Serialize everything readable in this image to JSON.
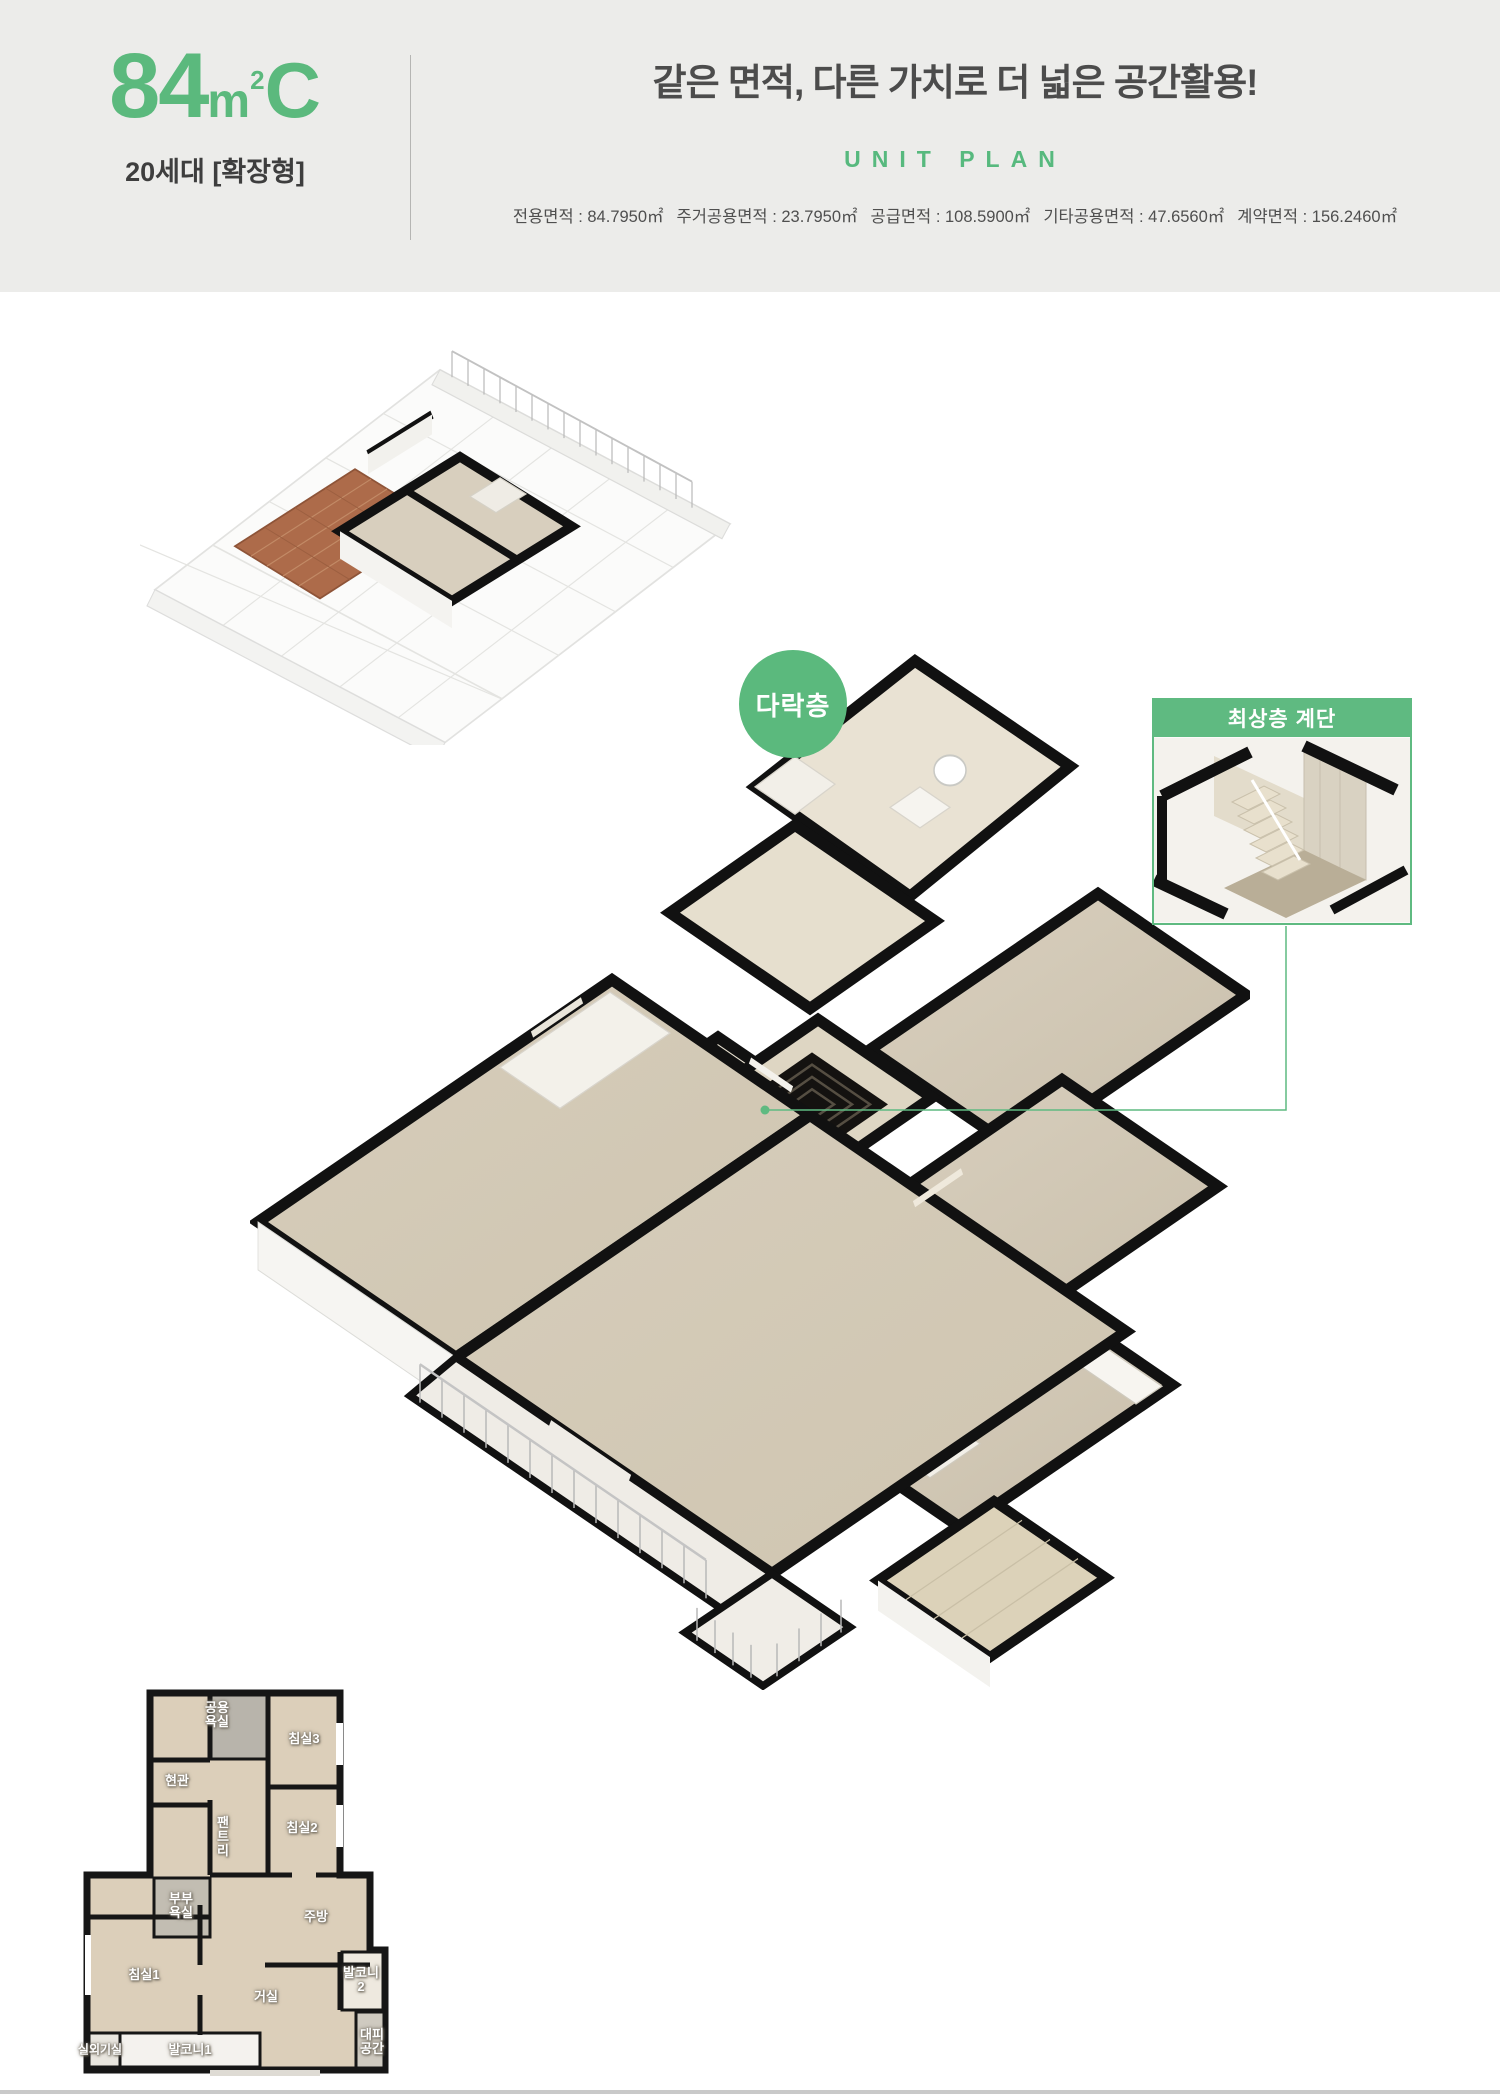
{
  "accent_color": "#5bb97d",
  "header": {
    "unit_number": "84",
    "unit_m": "m",
    "unit_sup": "2",
    "unit_type_letter": "C",
    "subtitle": "20세대 [확장형]",
    "title": "같은 면적, 다른 가치로 더 넓은 공간활용!",
    "unit_plan_label": "UNIT PLAN",
    "area_items": [
      "전용면적 : 84.7950㎡",
      "주거공용면적 : 23.7950㎡",
      "공급면적 : 108.5900㎡",
      "기타공용면적 : 47.6560㎡",
      "계약면적 : 156.2460㎡"
    ]
  },
  "plan": {
    "attic_badge": "다락층",
    "callout_title": "최상층 계단"
  },
  "miniplan": {
    "rooms": [
      "공용\n욕실",
      "침실3",
      "현관",
      "팬\n트\n리",
      "침실2",
      "부부\n욕실",
      "주방",
      "침실1",
      "거실",
      "발코니2",
      "발코니1",
      "실외기실",
      "대피\n공간"
    ]
  }
}
